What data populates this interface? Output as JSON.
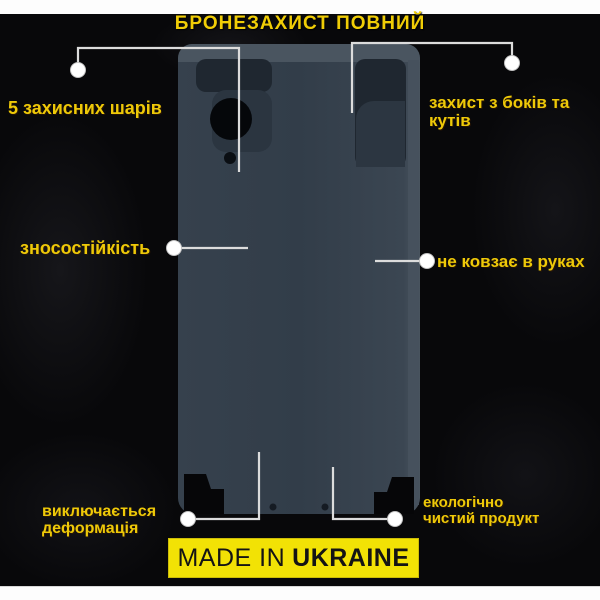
{
  "title": "БРОНЕЗАХИСТ ПОВНИЙ",
  "callouts": [
    {
      "id": "layers",
      "label": "5 захисних шарів"
    },
    {
      "id": "sides",
      "label": "захист з боків та\nкутів"
    },
    {
      "id": "wear",
      "label": "зносостійкість"
    },
    {
      "id": "grip",
      "label": "не ковзає в руках"
    },
    {
      "id": "deform",
      "label": "виключається\nдеформація"
    },
    {
      "id": "eco",
      "label": "екологічно\nчистий продукт"
    }
  ],
  "badge": {
    "prefix": "MADE IN",
    "country": "UKRAINE"
  },
  "colors": {
    "background": "#08080A",
    "accent_yellow": "#EEC908",
    "badge_yellow": "#F2E205",
    "badge_text": "#141414",
    "film_base": "#343F4B",
    "film_edge_highlight": "#4A5560",
    "film_cutout_dark": "#1F2730",
    "camera_black": "#05070A",
    "callout_line": "#DCDCDC",
    "callout_dot": "#FFFFFF",
    "white_band": "#FDFDFD"
  }
}
